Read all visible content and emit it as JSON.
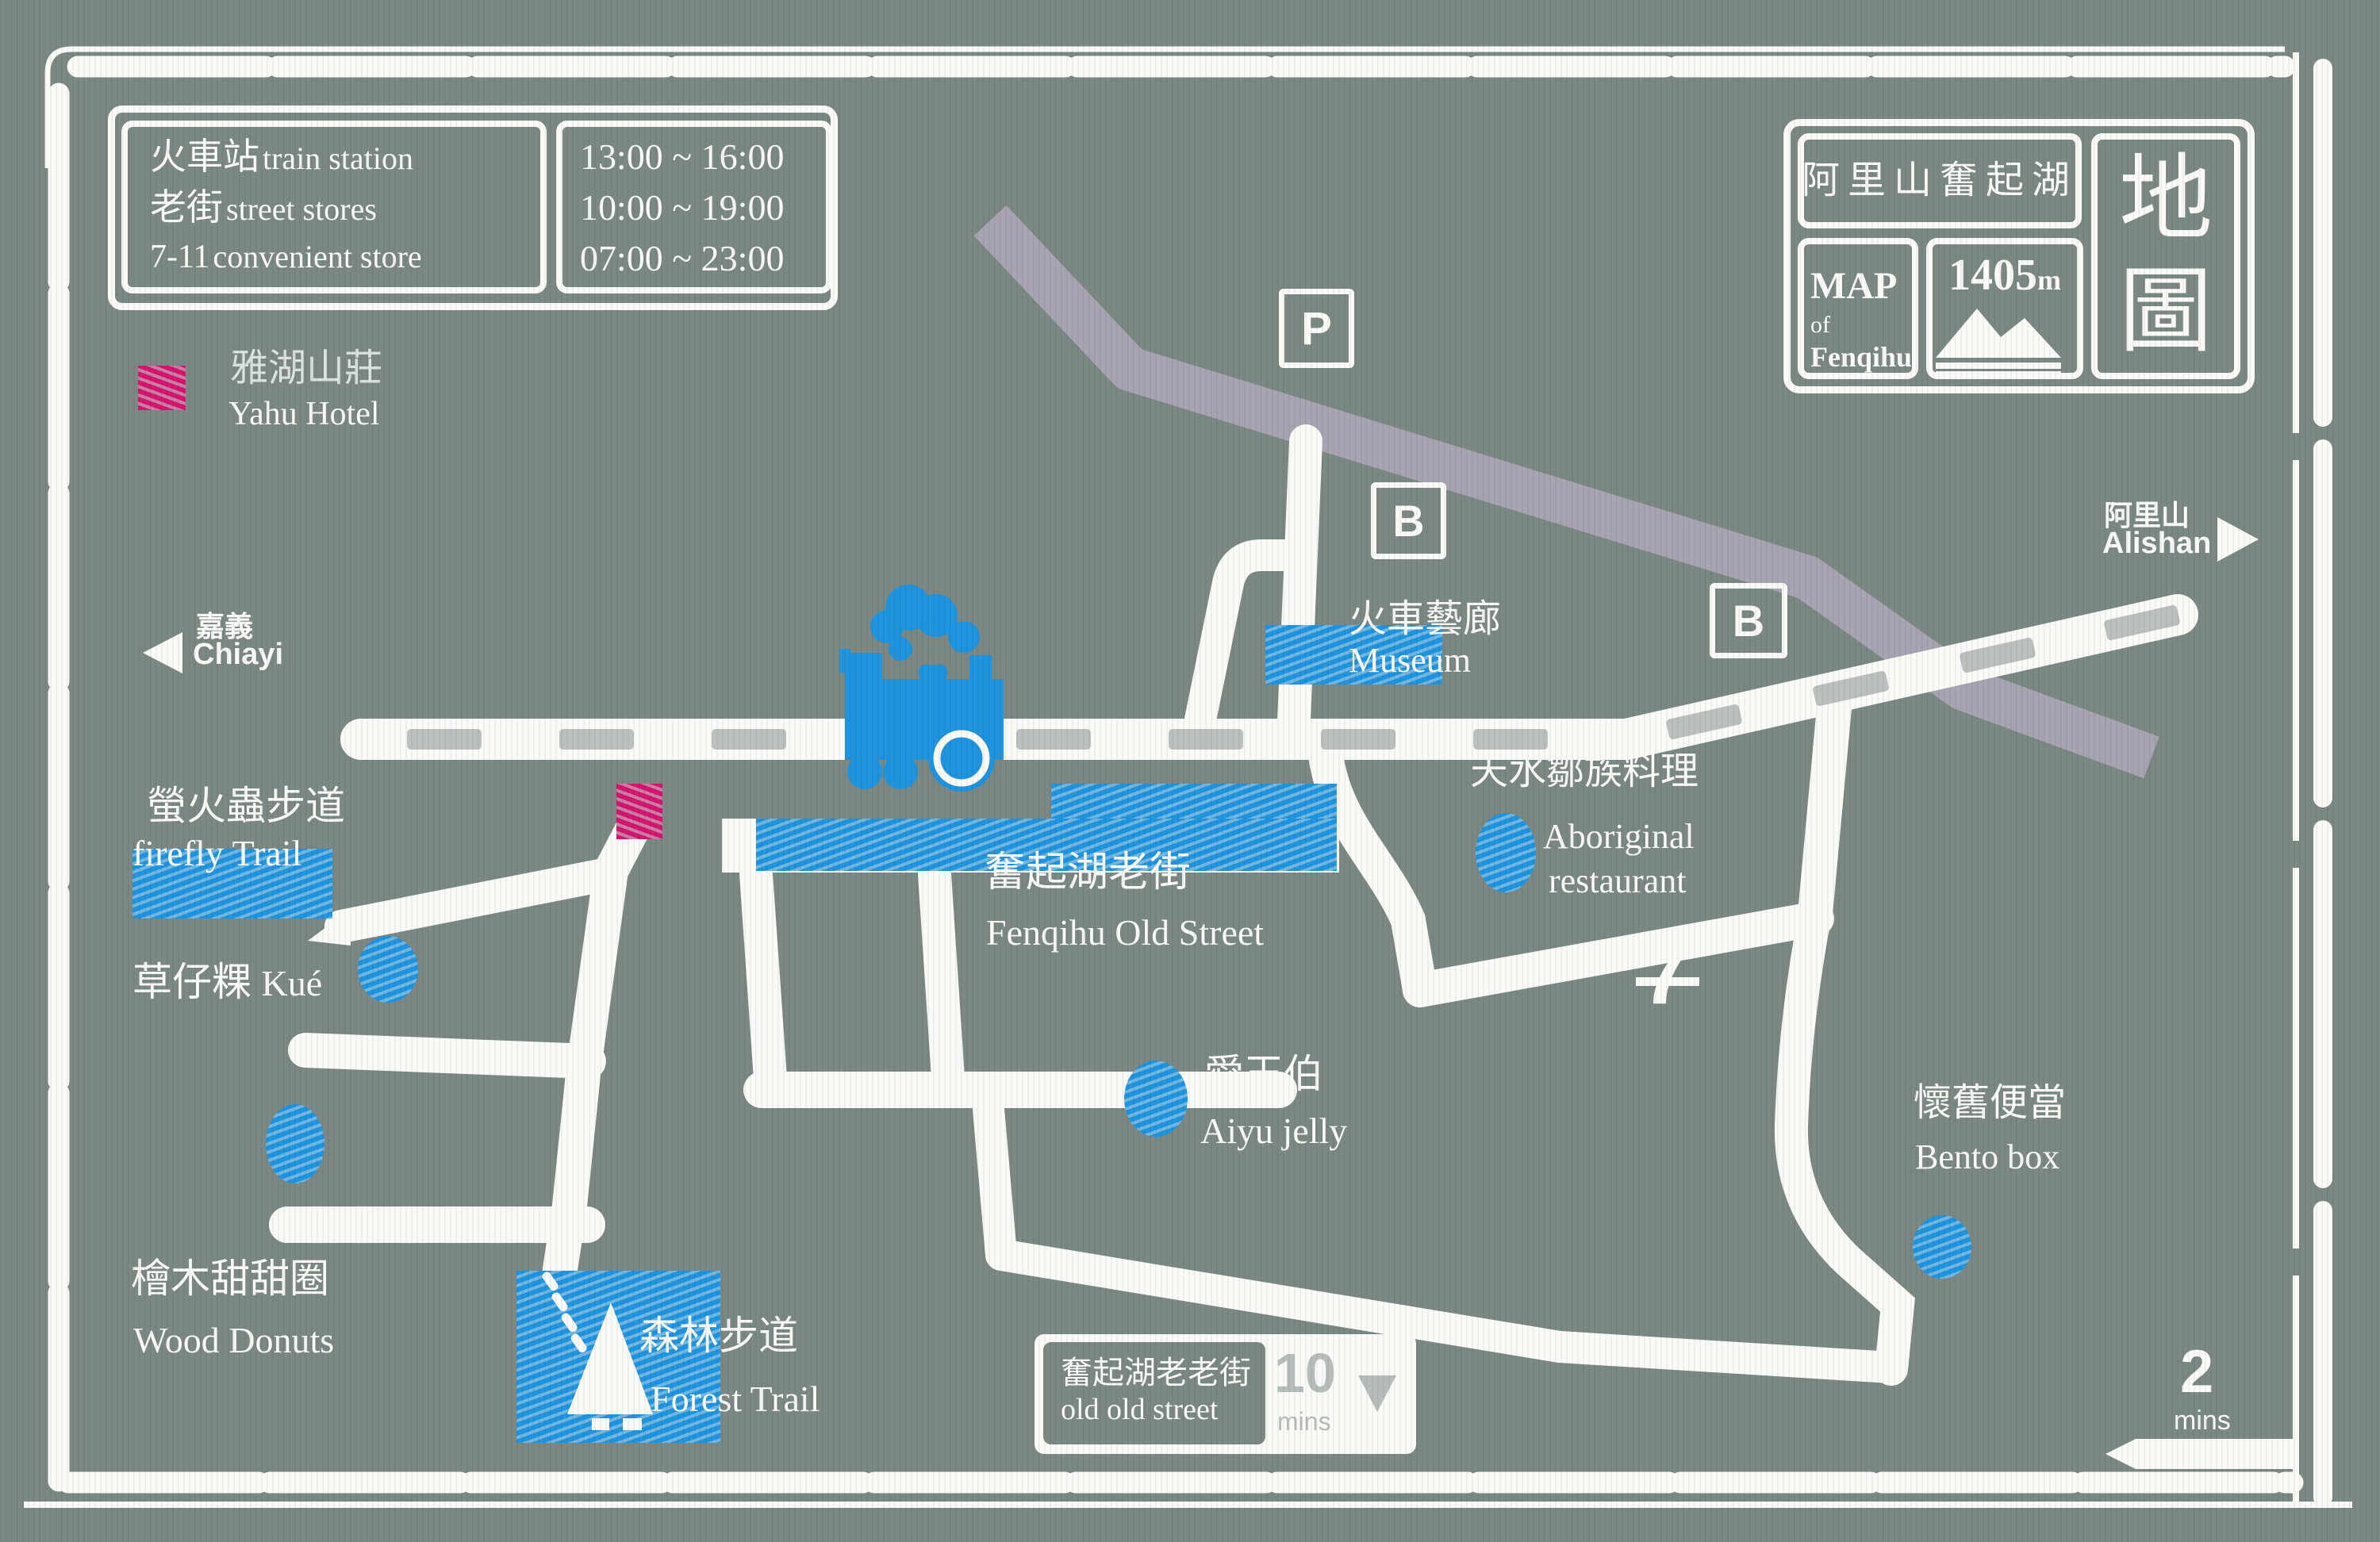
{
  "colors": {
    "background": "#7B8783",
    "white": "#FAFAF7",
    "blue": "#1E93DE",
    "blue_light": "#6FB7E2",
    "magenta": "#D4146E",
    "magenta_light": "#C97FA4",
    "gray_road": "#A7A3B1",
    "tie_gray": "#BCC0BD",
    "muted": "#B6BCB8"
  },
  "info_box": {
    "rows": [
      {
        "zh": "火車站",
        "en": "train station",
        "time": "13:00 ~ 16:00"
      },
      {
        "zh": "老街",
        "en": "street stores",
        "time": "10:00 ~ 19:00"
      },
      {
        "zh": "7-11",
        "en": "convenient store",
        "time": "07:00 ~ 23:00"
      }
    ]
  },
  "legend": {
    "zh": "雅湖山莊",
    "en": "Yahu Hotel"
  },
  "title_box": {
    "region_zh": "阿里山奮起湖",
    "map_label": "MAP",
    "of_label": "of",
    "place_label": "Fenqihu",
    "elevation": "1405",
    "elevation_unit": "m",
    "map_zh_1": "地",
    "map_zh_2": "圖"
  },
  "directions": {
    "west": {
      "zh": "嘉義",
      "en": "Chiayi"
    },
    "east": {
      "zh": "阿里山",
      "en": "Alishan"
    }
  },
  "markers": {
    "parking": "P",
    "bus": "B",
    "route_number": "7"
  },
  "pois": {
    "museum": {
      "zh": "火車藝廊",
      "en": "Museum"
    },
    "old_street": {
      "zh": "奮起湖老街",
      "en": "Fenqihu Old Street"
    },
    "aboriginal": {
      "zh": "天水鄒族料理",
      "en_1": "Aboriginal",
      "en_2": "restaurant"
    },
    "firefly": {
      "zh": "螢火蟲步道",
      "en": "firefly Trail"
    },
    "kue": {
      "zh": "草仔粿",
      "en": "Kué"
    },
    "aiyu": {
      "zh": "愛玉伯",
      "en": "Aiyu jelly"
    },
    "wood_donuts": {
      "zh": "檜木甜甜圈",
      "en": "Wood Donuts"
    },
    "forest": {
      "zh": "森林步道",
      "en": "Forest Trail"
    },
    "bento": {
      "zh": "懷舊便當",
      "en": "Bento box"
    }
  },
  "footer": {
    "old_old_street": {
      "zh": "奮起湖老老街",
      "en": "old old street",
      "minutes": "10",
      "unit": "mins"
    },
    "corner_walk": {
      "minutes": "2",
      "unit": "mins"
    }
  }
}
